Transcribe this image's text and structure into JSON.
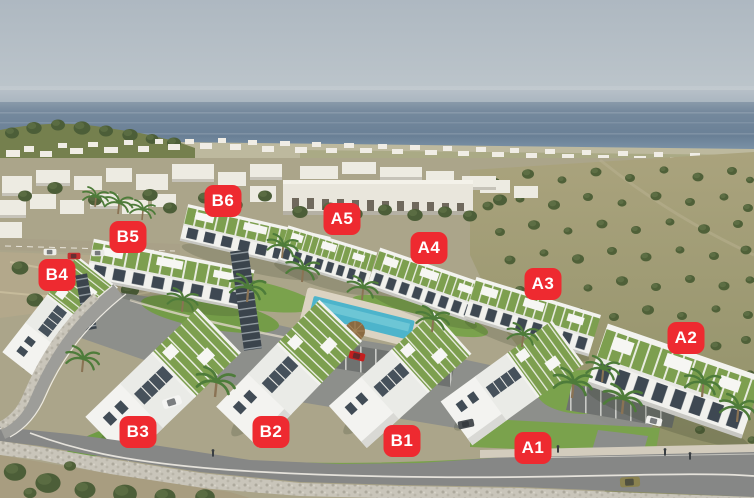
{
  "scene": {
    "description": "Aerial 3D render of a seaside residential complex with white apartment blocks, green roof gardens, a pool, olive groves and the sea on the horizon; eleven red tags mark the blocks",
    "label_color": "#ee2a30",
    "label_text_color": "#ffffff",
    "sky_color": "#b0bac2",
    "sea_color": "#6d8299",
    "field_color": "#a29c77",
    "lawn_color": "#7aa24c",
    "building_color": "#f2f2ee",
    "roof_garden_color": "#7d9f4f",
    "road_color": "#868786",
    "pool_color": "#4db4cb"
  },
  "labels": [
    {
      "text": "B6",
      "x": 223,
      "y": 201
    },
    {
      "text": "A5",
      "x": 342,
      "y": 219
    },
    {
      "text": "B5",
      "x": 128,
      "y": 237
    },
    {
      "text": "A4",
      "x": 429,
      "y": 248
    },
    {
      "text": "B4",
      "x": 57,
      "y": 275
    },
    {
      "text": "A3",
      "x": 543,
      "y": 284
    },
    {
      "text": "A2",
      "x": 686,
      "y": 338
    },
    {
      "text": "B3",
      "x": 138,
      "y": 432
    },
    {
      "text": "B2",
      "x": 271,
      "y": 432
    },
    {
      "text": "B1",
      "x": 402,
      "y": 441
    },
    {
      "text": "A1",
      "x": 533,
      "y": 448
    }
  ]
}
